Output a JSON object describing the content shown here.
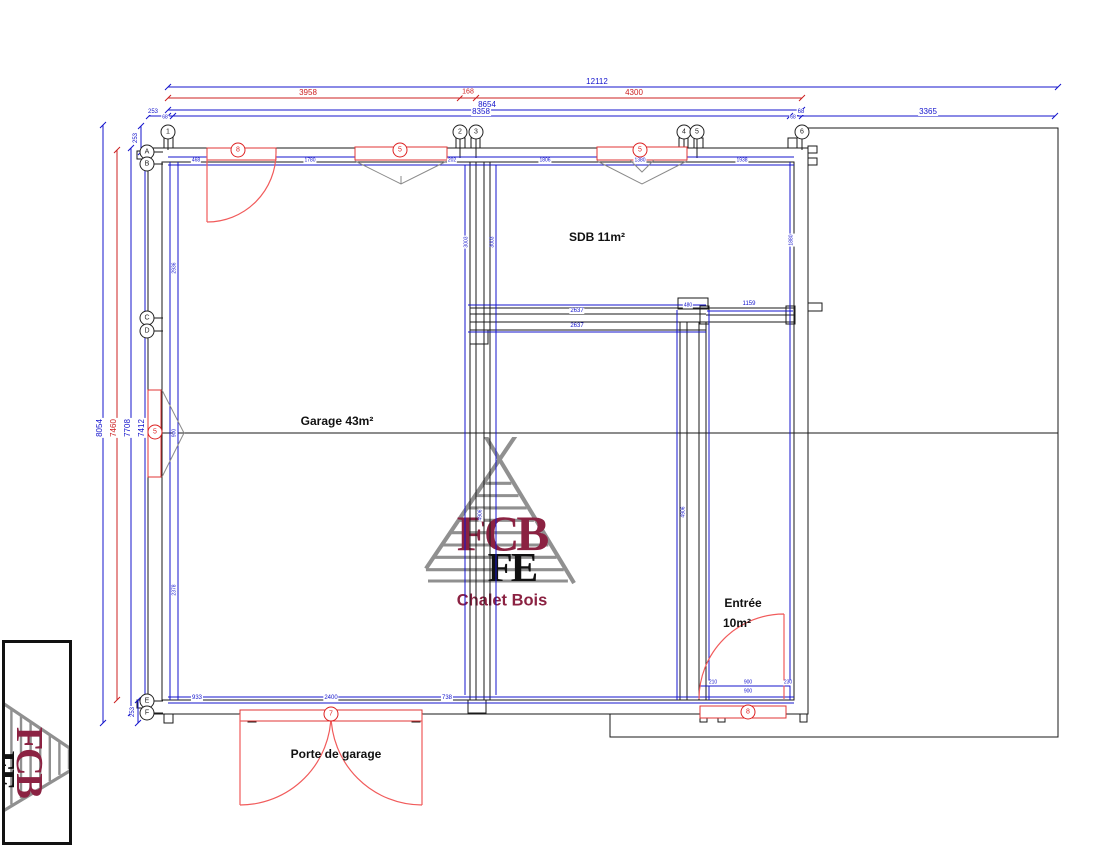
{
  "labels": {
    "garage": "Garage 43m²",
    "sdb": "SDB 11m²",
    "entree_line1": "Entrée",
    "entree_line2": "10m²",
    "porte_garage": "Porte de garage"
  },
  "logo": {
    "acronym": "FCB",
    "overlay": "FE",
    "name": "Chalet Bois"
  },
  "colors": {
    "dimension_blue": "#1414cc",
    "dimension_red": "#cc2020",
    "opening_red": "#e03434",
    "door_arc_red": "#f15b5b",
    "logo_maroon": "#8b2242",
    "logo_gray": "#909090",
    "wall_black": "#1a1a1a"
  },
  "grid_bubbles_top": [
    {
      "label": "1",
      "x": 168,
      "y": 132
    },
    {
      "label": "2",
      "x": 460,
      "y": 132
    },
    {
      "label": "3",
      "x": 476,
      "y": 132
    },
    {
      "label": "4",
      "x": 684,
      "y": 132
    },
    {
      "label": "5",
      "x": 697,
      "y": 132
    },
    {
      "label": "6",
      "x": 802,
      "y": 132
    }
  ],
  "grid_bubbles_left": [
    {
      "label": "A",
      "x": 147,
      "y": 152
    },
    {
      "label": "B",
      "x": 147,
      "y": 164
    },
    {
      "label": "C",
      "x": 147,
      "y": 318
    },
    {
      "label": "D",
      "x": 147,
      "y": 331
    },
    {
      "label": "E",
      "x": 147,
      "y": 701
    },
    {
      "label": "F",
      "x": 147,
      "y": 713
    }
  ],
  "opening_markers": [
    {
      "label": "8",
      "x": 238,
      "y": 150
    },
    {
      "label": "5",
      "x": 400,
      "y": 150
    },
    {
      "label": "5",
      "x": 640,
      "y": 150
    },
    {
      "label": "5",
      "x": 155,
      "y": 432
    },
    {
      "label": "7",
      "x": 331,
      "y": 714
    },
    {
      "label": "8",
      "x": 748,
      "y": 712
    }
  ],
  "dimensions": [
    {
      "t": "12112",
      "x": 597,
      "y": 82,
      "c": "#1414cc",
      "s": 8
    },
    {
      "t": "3958",
      "x": 308,
      "y": 93,
      "c": "#cc2020",
      "s": 8
    },
    {
      "t": "168",
      "x": 468,
      "y": 92,
      "c": "#cc2020",
      "s": 7
    },
    {
      "t": "4300",
      "x": 634,
      "y": 93,
      "c": "#cc2020",
      "s": 8
    },
    {
      "t": "8654",
      "x": 487,
      "y": 105,
      "c": "#1414cc",
      "s": 8
    },
    {
      "t": "253",
      "x": 153,
      "y": 112,
      "c": "#1414cc",
      "s": 6
    },
    {
      "t": "68",
      "x": 165,
      "y": 118,
      "c": "#1414cc",
      "s": 5
    },
    {
      "t": "8358",
      "x": 481,
      "y": 112,
      "c": "#1414cc",
      "s": 8
    },
    {
      "t": "68",
      "x": 793,
      "y": 118,
      "c": "#1414cc",
      "s": 5
    },
    {
      "t": "68",
      "x": 801,
      "y": 112,
      "c": "#1414cc",
      "s": 6
    },
    {
      "t": "3365",
      "x": 928,
      "y": 112,
      "c": "#1414cc",
      "s": 8
    },
    {
      "t": "8054",
      "x": 100,
      "y": 428,
      "c": "#1414cc",
      "s": 8,
      "r": -90
    },
    {
      "t": "7460",
      "x": 114,
      "y": 428,
      "c": "#cc2020",
      "s": 8,
      "r": -90
    },
    {
      "t": "7708",
      "x": 128,
      "y": 428,
      "c": "#1414cc",
      "s": 8,
      "r": -90
    },
    {
      "t": "7412",
      "x": 142,
      "y": 428,
      "c": "#1414cc",
      "s": 8,
      "r": -90
    },
    {
      "t": "253",
      "x": 136,
      "y": 138,
      "c": "#1414cc",
      "s": 6,
      "r": -90
    },
    {
      "t": "68",
      "x": 145,
      "y": 155,
      "c": "#1414cc",
      "s": 5,
      "r": -90
    },
    {
      "t": "253",
      "x": 133,
      "y": 712,
      "c": "#1414cc",
      "s": 6,
      "r": -90
    },
    {
      "t": "68",
      "x": 143,
      "y": 700,
      "c": "#1414cc",
      "s": 5,
      "r": -90
    },
    {
      "t": "468",
      "x": 196,
      "y": 161,
      "c": "#1414cc",
      "s": 5
    },
    {
      "t": "1780",
      "x": 310,
      "y": 161,
      "c": "#1414cc",
      "s": 5
    },
    {
      "t": "202",
      "x": 452,
      "y": 161,
      "c": "#1414cc",
      "s": 5
    },
    {
      "t": "1806",
      "x": 545,
      "y": 161,
      "c": "#1414cc",
      "s": 5
    },
    {
      "t": "1380",
      "x": 640,
      "y": 161,
      "c": "#1414cc",
      "s": 5
    },
    {
      "t": "1938",
      "x": 742,
      "y": 161,
      "c": "#1414cc",
      "s": 5
    },
    {
      "t": "2936",
      "x": 175,
      "y": 268,
      "c": "#1414cc",
      "s": 5,
      "r": -90
    },
    {
      "t": "900",
      "x": 175,
      "y": 433,
      "c": "#1414cc",
      "s": 5,
      "r": -90
    },
    {
      "t": "2378",
      "x": 175,
      "y": 590,
      "c": "#1414cc",
      "s": 5,
      "r": -90
    },
    {
      "t": "3003",
      "x": 467,
      "y": 242,
      "c": "#1414cc",
      "s": 5,
      "r": -90
    },
    {
      "t": "3003",
      "x": 493,
      "y": 242,
      "c": "#1414cc",
      "s": 5,
      "r": -90
    },
    {
      "t": "4906",
      "x": 481,
      "y": 515,
      "c": "#1414cc",
      "s": 5,
      "r": -90
    },
    {
      "t": "1880",
      "x": 792,
      "y": 240,
      "c": "#1414cc",
      "s": 5,
      "r": -90
    },
    {
      "t": "4906",
      "x": 684,
      "y": 512,
      "c": "#1414cc",
      "s": 5,
      "r": -90
    },
    {
      "t": "2637",
      "x": 577,
      "y": 311,
      "c": "#1414cc",
      "s": 6
    },
    {
      "t": "2637",
      "x": 577,
      "y": 326,
      "c": "#1414cc",
      "s": 6
    },
    {
      "t": "480",
      "x": 688,
      "y": 306,
      "c": "#1414cc",
      "s": 5
    },
    {
      "t": "1159",
      "x": 749,
      "y": 304,
      "c": "#1414cc",
      "s": 6
    },
    {
      "t": "933",
      "x": 197,
      "y": 698,
      "c": "#1414cc",
      "s": 6
    },
    {
      "t": "2400",
      "x": 331,
      "y": 698,
      "c": "#1414cc",
      "s": 6
    },
    {
      "t": "738",
      "x": 447,
      "y": 698,
      "c": "#1414cc",
      "s": 6
    },
    {
      "t": "210",
      "x": 713,
      "y": 683,
      "c": "#1414cc",
      "s": 5
    },
    {
      "t": "900",
      "x": 748,
      "y": 683,
      "c": "#1414cc",
      "s": 5
    },
    {
      "t": "230",
      "x": 788,
      "y": 683,
      "c": "#1414cc",
      "s": 5
    },
    {
      "t": "900",
      "x": 748,
      "y": 692,
      "c": "#1414cc",
      "s": 5
    }
  ]
}
